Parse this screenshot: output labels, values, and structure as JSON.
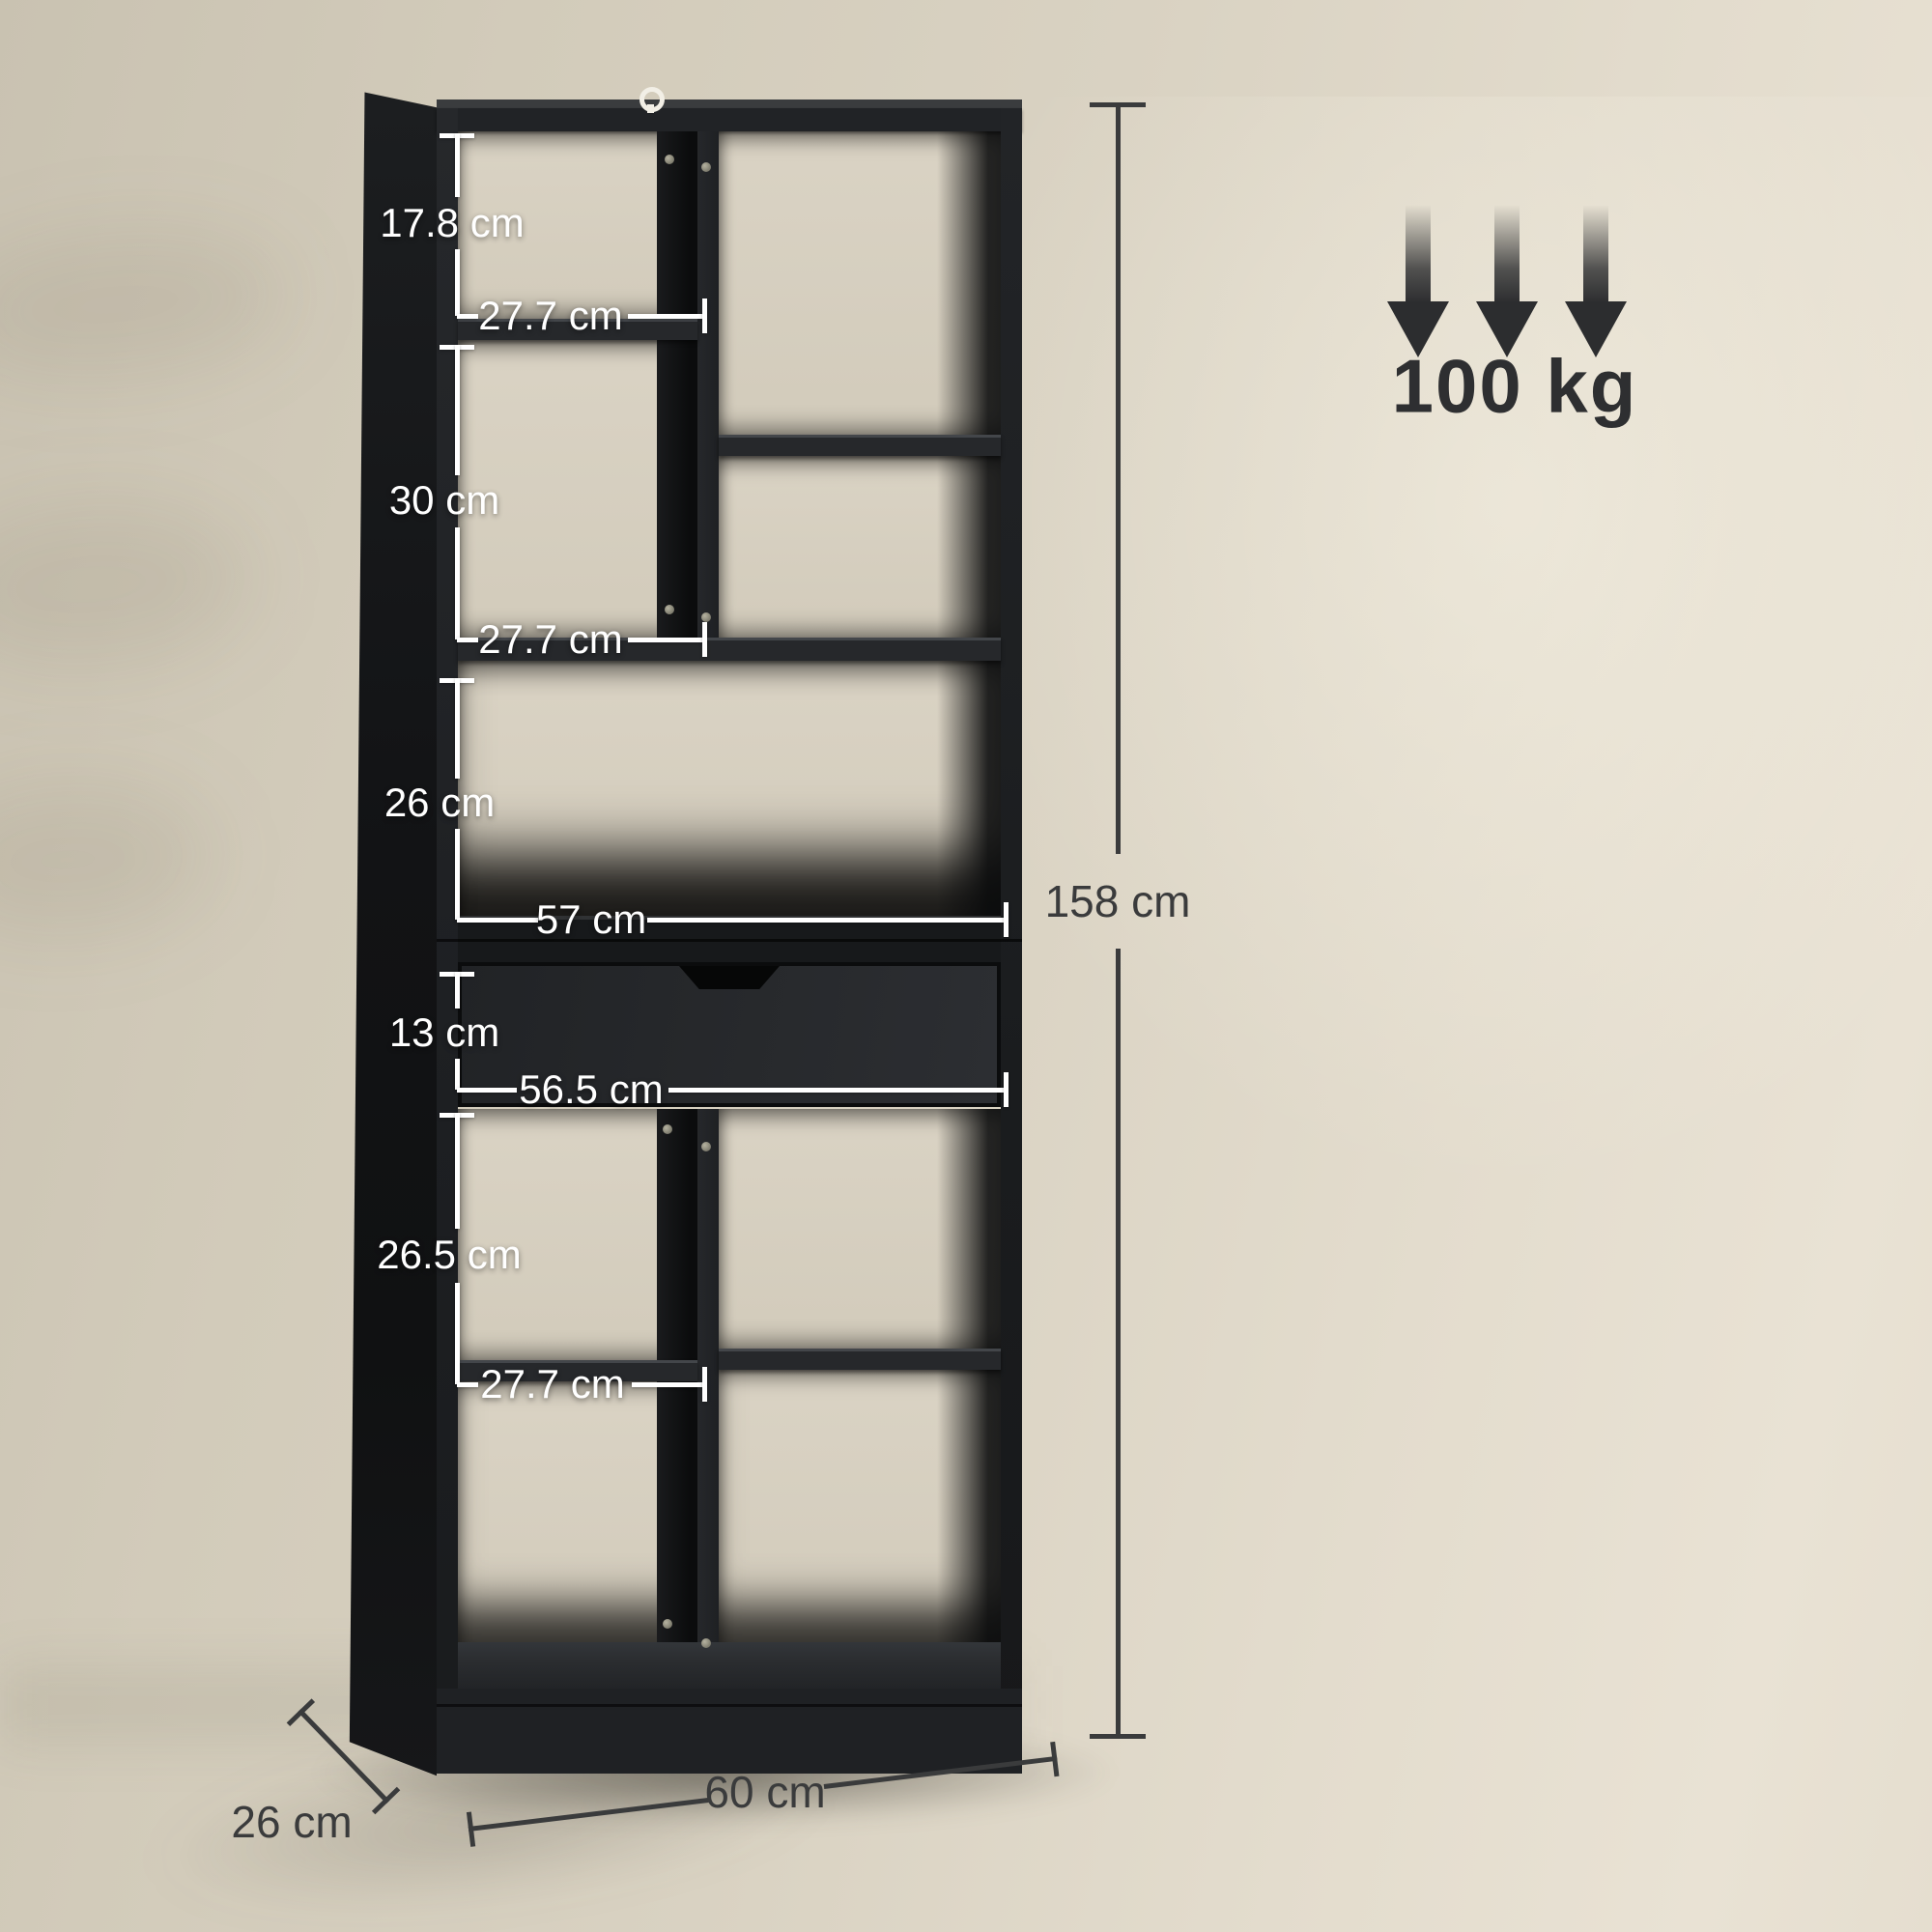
{
  "scene": {
    "description": "Product dimension diagram of a tall black bookcase with open cubbies and one drawer, standing against a beige wall"
  },
  "dimensions": {
    "upper_cubby_height": "17.8 cm",
    "upper_cubby_width": "27.7 cm",
    "middle_cubby_height": "30 cm",
    "middle_cubby_width": "27.7 cm",
    "open_shelf_height": "26 cm",
    "open_shelf_width": "57 cm",
    "drawer_height": "13 cm",
    "drawer_width": "56.5 cm",
    "lower_cubby_height": "26.5 cm",
    "lower_cubby_width": "27.7 cm",
    "total_height": "158 cm",
    "depth": "26 cm",
    "width": "60 cm"
  },
  "capacity": {
    "value": "100 kg",
    "icon": "triple-down-arrow"
  },
  "colors": {
    "wall": "#d9d2c2",
    "floor": "#f0eadb",
    "furniture_black": "#1f2124",
    "drawer_face": "#26282b",
    "dim_text_light": "#ffffff",
    "dim_text_dark": "#3a3b3c",
    "capacity_text": "#2e2f31"
  }
}
